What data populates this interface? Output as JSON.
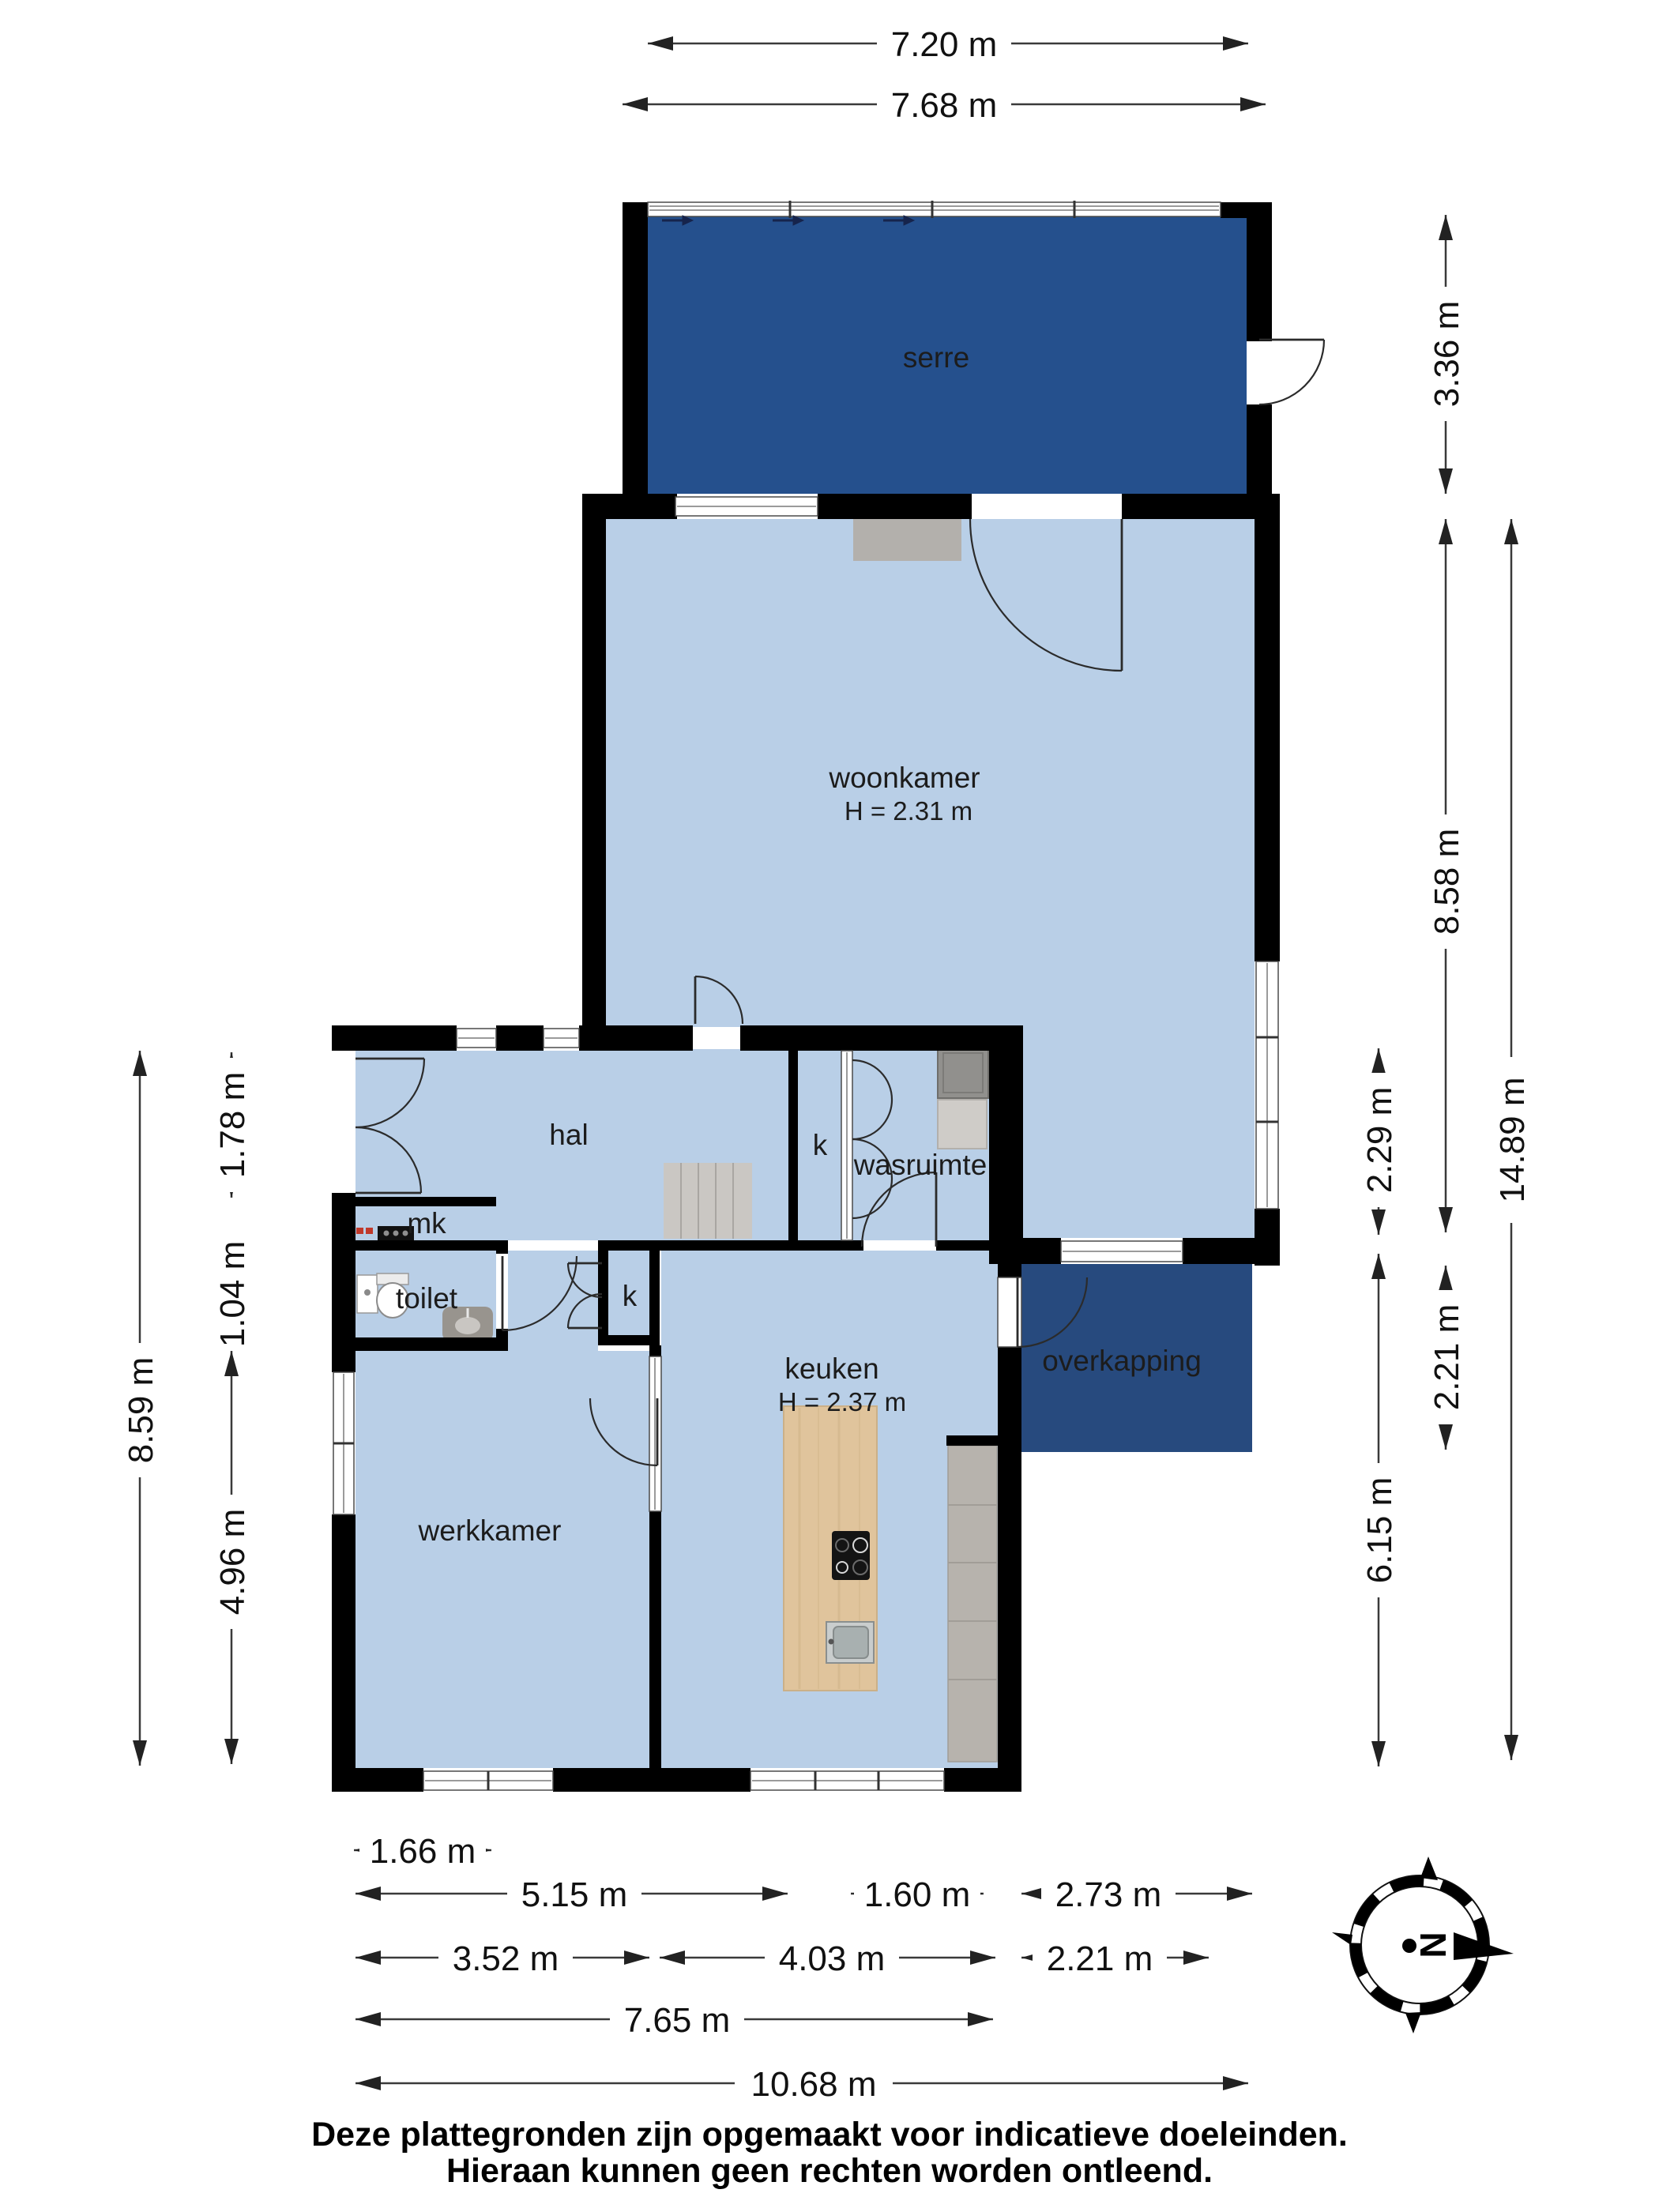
{
  "rooms": {
    "serre": {
      "label": "serre"
    },
    "woonkamer": {
      "label": "woonkamer",
      "height": "H = 2.31 m"
    },
    "hal": {
      "label": "hal"
    },
    "closet_hal": {
      "label": "k"
    },
    "wasruimte": {
      "label": "wasruimte"
    },
    "mk": {
      "label": "mk"
    },
    "toilet": {
      "label": "toilet"
    },
    "closet_keuken": {
      "label": "k"
    },
    "keuken": {
      "label": "keuken",
      "height": "H = 2.37 m"
    },
    "werkkamer": {
      "label": "werkkamer"
    },
    "overkapping": {
      "label": "overkapping"
    }
  },
  "dimensions": {
    "top": [
      "7.20 m",
      "7.68 m"
    ],
    "right": [
      "3.36 m",
      "8.58 m",
      "2.21 m",
      "2.29 m",
      "6.15 m",
      "14.89 m"
    ],
    "left": [
      "8.59 m",
      "1.78 m",
      "1.04 m",
      "4.96 m"
    ],
    "bottom": [
      "1.66 m",
      "5.15 m",
      "1.60 m",
      "2.73 m",
      "3.52 m",
      "4.03 m",
      "2.21 m",
      "7.65 m",
      "10.68 m"
    ]
  },
  "compass": {
    "north_label": "N"
  },
  "footer": {
    "line1": "Deze plattegronden zijn opgemaakt voor indicatieve doeleinden.",
    "line2": "Hieraan kunnen geen rechten worden ontleend."
  },
  "colors": {
    "room_fill": "#b9cfe7",
    "serre_fill": "#25508d",
    "overkapping_fill": "#274a7e",
    "wall": "#000000",
    "stairs_gray": "#cac7c3",
    "counter_gray": "#b7b3ad",
    "wood": "#e0c49c"
  }
}
